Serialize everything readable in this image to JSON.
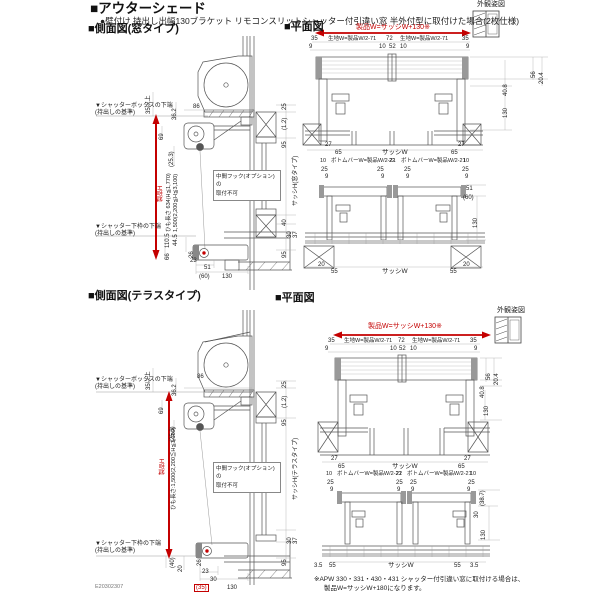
{
  "header": {
    "title": "■アウターシェード",
    "subtitle": "●壁付け 持出し出幅130ブラケット リモコンスリットシャッター付引違い窓 半外付型に取付けた場合(2枚仕様)"
  },
  "s1": {
    "sideTitle": "■側面図(窓タイプ)",
    "planTitle": "■平面図",
    "gaikan": "外観姿図",
    "side": {
      "boxRef1": "▼シャッターボックスの下端",
      "boxRef2": "(持出しの基準)",
      "minClear": "35以上",
      "d36_2": "36.2",
      "d86": "86",
      "d69": "69",
      "d25_3": "(25.3)",
      "productH": "製品H",
      "cord1": "ひも長さ 634(H≦1,770)",
      "cord2": "1,500(2,200≦H≦3,100)",
      "hook1": "中間フック(オプション)の",
      "hook2": "取付不可",
      "sillRef1": "▼シャッター下枠の下端",
      "sillRef2": "(持出しの基準)",
      "d110_5": "110.5",
      "d44_5": "44.5",
      "d66": "66",
      "d26": "26",
      "d23": "23",
      "d51": "51",
      "d60": "(60)",
      "d130": "130",
      "d25": "25",
      "d1_2": "(1.2)",
      "d95t": "95",
      "sashH": "サッシH(窓タイプ)",
      "d40": "40",
      "d30": "30",
      "d37": "37",
      "d95b": "95"
    },
    "plan": {
      "productW": "製品W=サッシW+130※",
      "d35a": "35",
      "fabricL": "生地W=製品W/2-71",
      "d72": "72",
      "fabricR": "生地W=製品W/2-71",
      "d35b": "35",
      "d9a": "9",
      "d10a": "10",
      "d52": "52",
      "d10b": "10",
      "d9b": "9",
      "d56": "56",
      "d20_4": "20.4",
      "d40_8": "40.8",
      "d130a": "130",
      "d27a": "27",
      "d27b": "27",
      "d65a": "65",
      "sashW1": "サッシW",
      "d65b": "65",
      "d10c": "10",
      "bbarL": "ボトムバーW=製品W/2-21",
      "d22": "22",
      "bbarR": "ボトムバーW=製品W/2-21",
      "d10d": "10",
      "d25a": "25",
      "d25b": "25",
      "d25c": "25",
      "d25d": "25",
      "d9c": "9",
      "d9d": "9",
      "d9e": "9",
      "d9f": "9",
      "d51": "51",
      "d60": "(60)",
      "d130b": "130",
      "d20a": "20",
      "d55a": "55",
      "sashW2": "サッシW",
      "d55b": "55",
      "d20b": "20"
    }
  },
  "s2": {
    "sideTitle": "■側面図(テラスタイプ)",
    "planTitle": "■平面図",
    "gaikan": "外観姿図",
    "side": {
      "boxRef1": "▼シャッターボックスの下端",
      "boxRef2": "(持出しの基準)",
      "minClear": "35以上",
      "d36_2": "36.2",
      "d86": "86",
      "d69": "69",
      "d25_3": "(25.3)",
      "productH": "製品H",
      "cord": "ひも長さ:1,500(2,200≦H≦3,100)",
      "hook1": "中間フック(オプション)の",
      "hook2": "取付不可",
      "sillRef1": "▼シャッター下枠の下端",
      "sillRef2": "(持出しの基準)",
      "d40p": "(40)",
      "d20": "20",
      "d26": "26",
      "d23": "23",
      "d30": "30",
      "d35p": "(35)",
      "d130": "130",
      "d25": "25",
      "d1_2": "(1.2)",
      "d95t": "95",
      "sashH": "サッシH(テラスタイプ)",
      "d30b": "30",
      "d37": "37",
      "d95b": "95"
    },
    "plan": {
      "productW": "製品W=サッシW+130※",
      "d35a": "35",
      "fabricL": "生地W=製品W/2-71",
      "d72": "72",
      "fabricR": "生地W=製品W/2-71",
      "d35b": "35",
      "d9a": "9",
      "d10a": "10",
      "d52": "52",
      "d10b": "10",
      "d9b": "9",
      "d56": "56",
      "d20_4": "20.4",
      "d40_8": "40.8",
      "d130a": "130",
      "d27a": "27",
      "d27b": "27",
      "d65a": "65",
      "sashW1": "サッシW",
      "d65b": "65",
      "d10c": "10",
      "bbarL": "ボトムバーW=製品W/2-21",
      "d22": "22",
      "bbarR": "ボトムバーW=製品W/2-21",
      "d10d": "10",
      "d25a": "25",
      "d25b": "25",
      "d25c": "25",
      "d25d": "25",
      "d9c": "9",
      "d9d": "9",
      "d9e": "9",
      "d9f": "9",
      "d38_7": "(38.7)",
      "d30": "30",
      "d130b": "130",
      "d3_5a": "3.5",
      "d55a": "55",
      "sashW2": "サッシW",
      "d55b": "55",
      "d3_5b": "3.5"
    }
  },
  "footer": {
    "note1": "※APW 330・331・430・431 シャッター付引違い窓に取付ける場合は、",
    "note2": "製品W=サッシW+180になります。",
    "docCode": "E20302307"
  },
  "colors": {
    "accentRed": "#c40000",
    "lineGray": "#555555"
  }
}
